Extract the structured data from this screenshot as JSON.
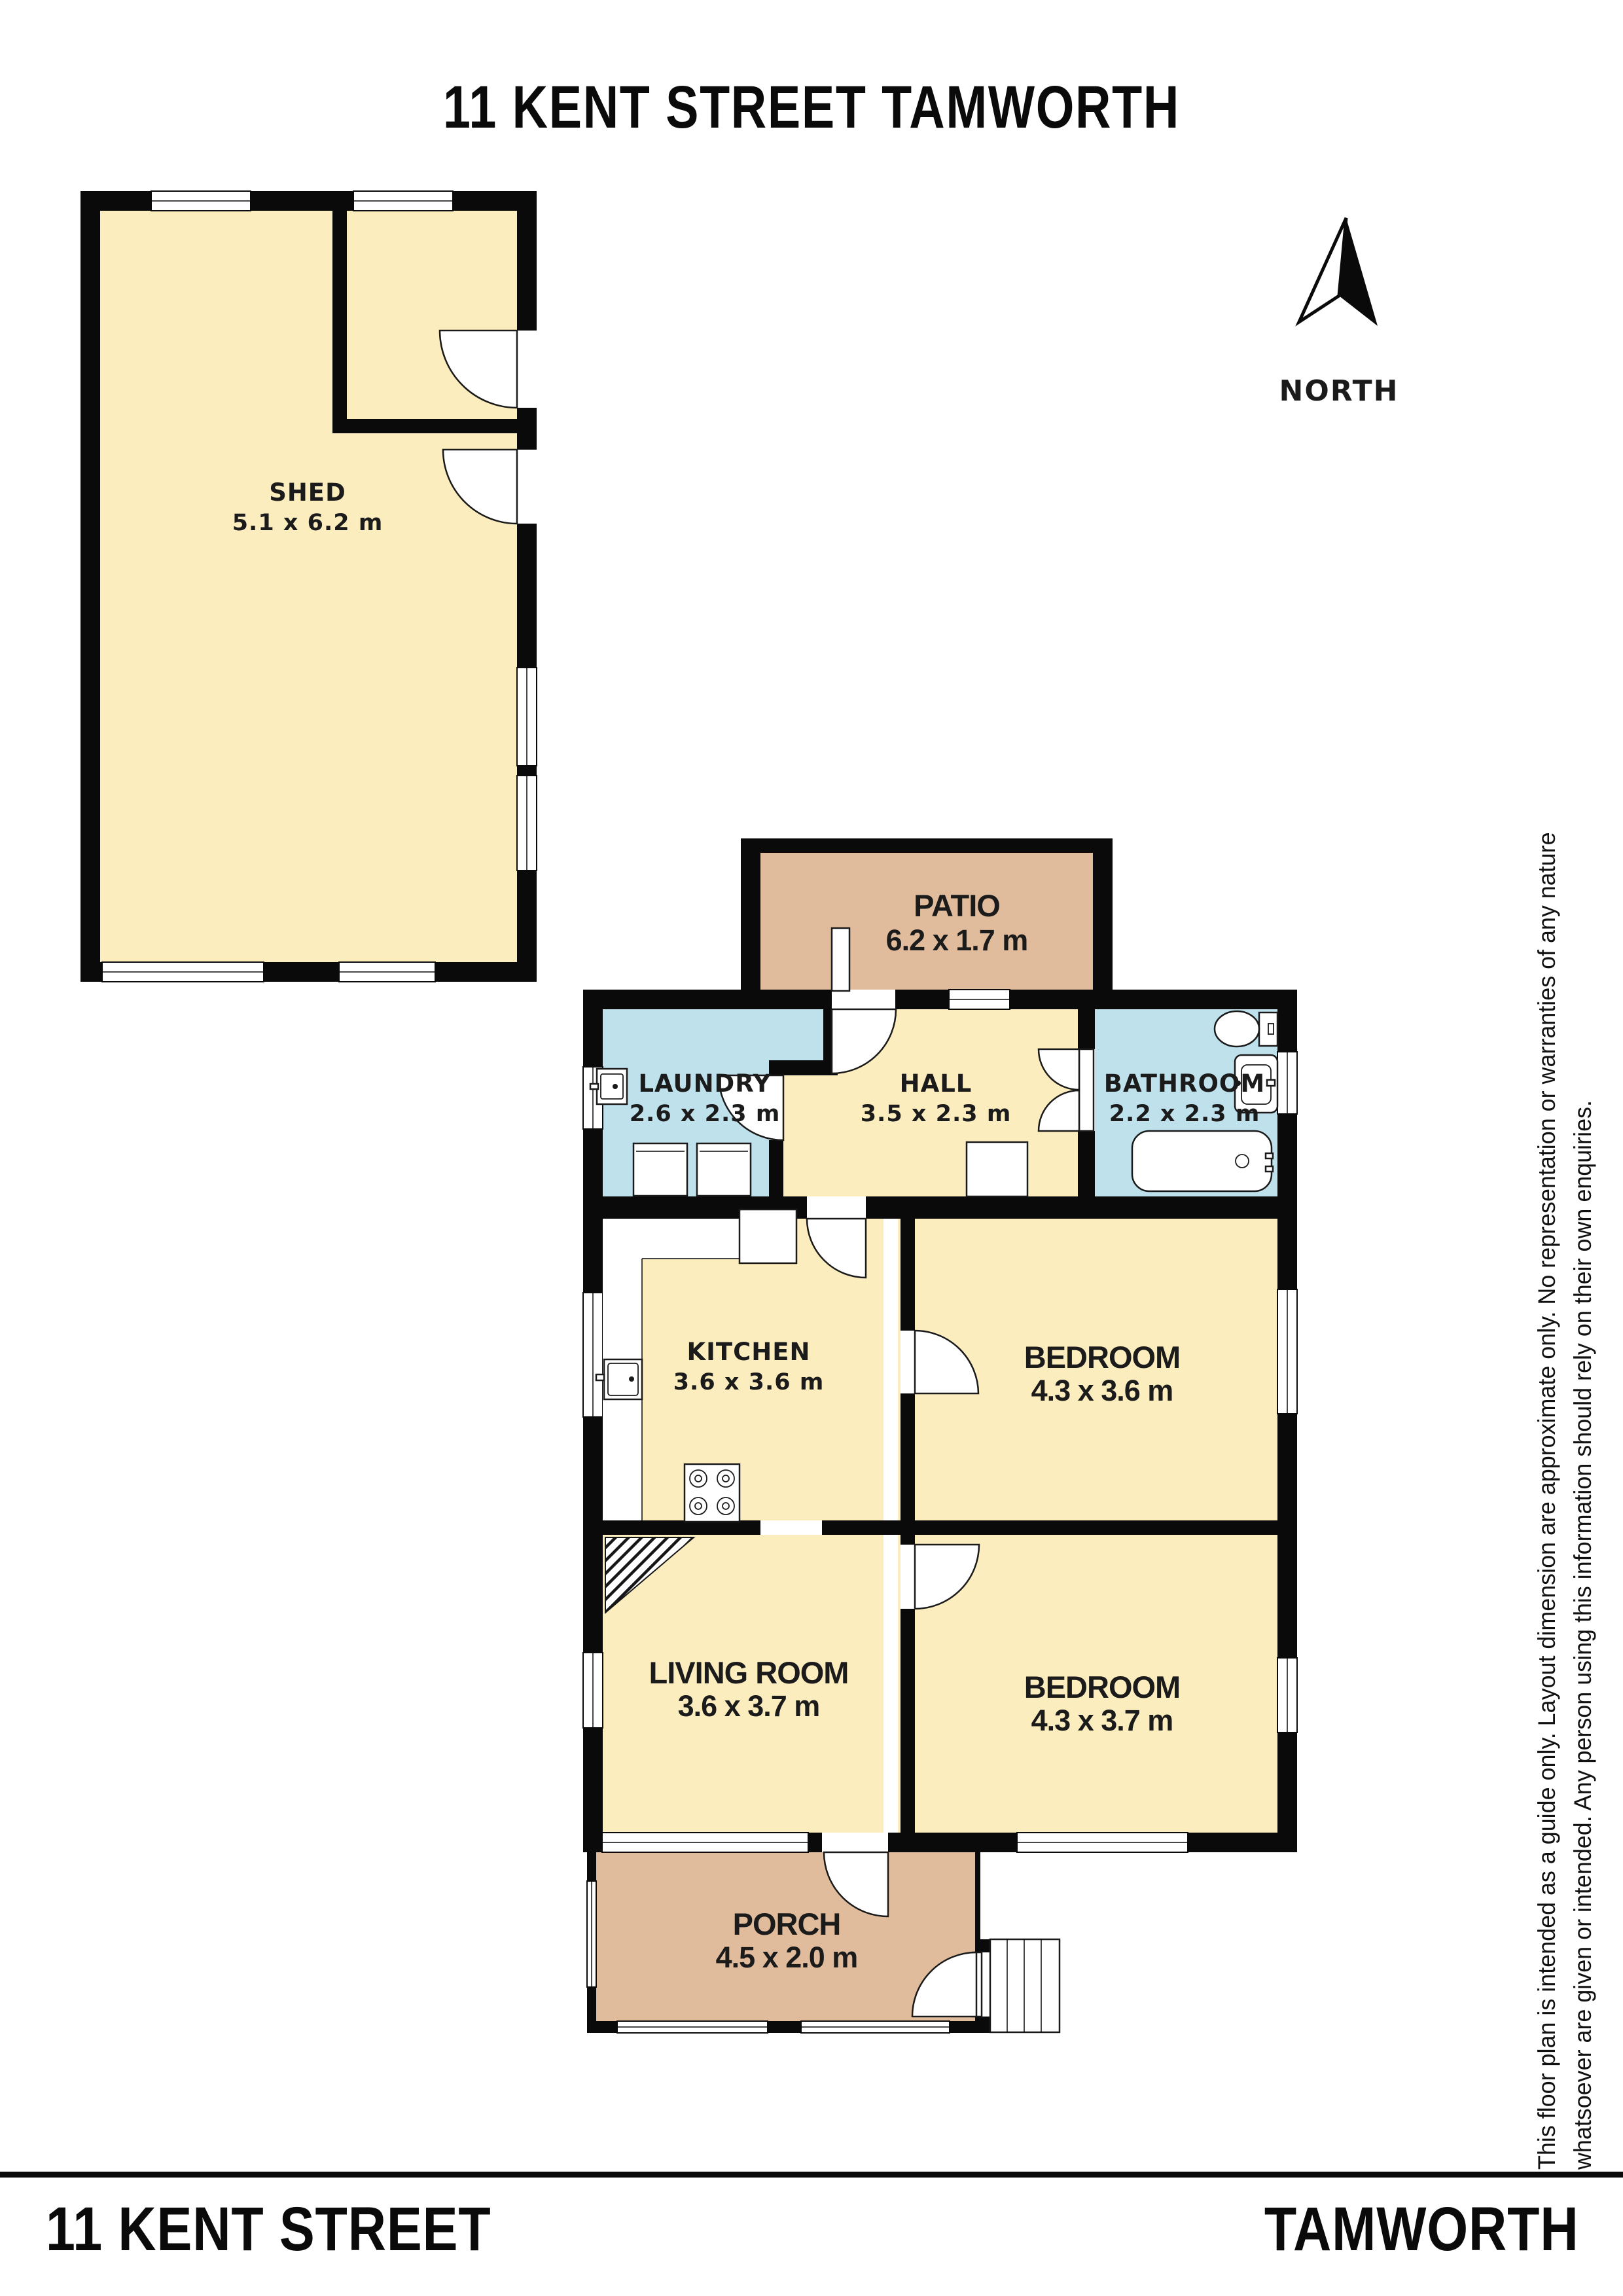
{
  "title": "11 KENT STREET TAMWORTH",
  "north": {
    "label": "NORTH"
  },
  "rooms": {
    "shed": {
      "name": "SHED",
      "dims": "5.1 x 6.2 m"
    },
    "patio": {
      "name": "PATIO",
      "dims": "6.2 x 1.7 m"
    },
    "laundry": {
      "name": "LAUNDRY",
      "dims": "2.6 x 2.3 m"
    },
    "hall": {
      "name": "HALL",
      "dims": "3.5 x 2.3 m"
    },
    "bathroom": {
      "name": "BATHROOM",
      "dims": "2.2 x 2.3 m"
    },
    "kitchen": {
      "name": "KITCHEN",
      "dims": "3.6 x 3.6 m"
    },
    "bedroom1": {
      "name": "BEDROOM",
      "dims": "4.3 x 3.6 m"
    },
    "living": {
      "name": "LIVING ROOM",
      "dims": "3.6 x 3.7 m"
    },
    "bedroom2": {
      "name": "BEDROOM",
      "dims": "4.3 x 3.7 m"
    },
    "porch": {
      "name": "PORCH",
      "dims": "4.5 x 2.0 m"
    }
  },
  "disclaimer": {
    "line1": "This floor plan is intended as a guide only. Layout dimension are approximate only. No representation or warranties of any nature",
    "line2": "whatsoever are given or intended. Any person using this information should rely on their own enquiries."
  },
  "footer": {
    "left": "11 KENT STREET",
    "right": "TAMWORTH"
  },
  "colors": {
    "floor_cream": "#FCEDBE",
    "floor_tan": "#E0BC9C",
    "floor_blue": "#BFE1EC",
    "wall": "#0A0A0A"
  }
}
